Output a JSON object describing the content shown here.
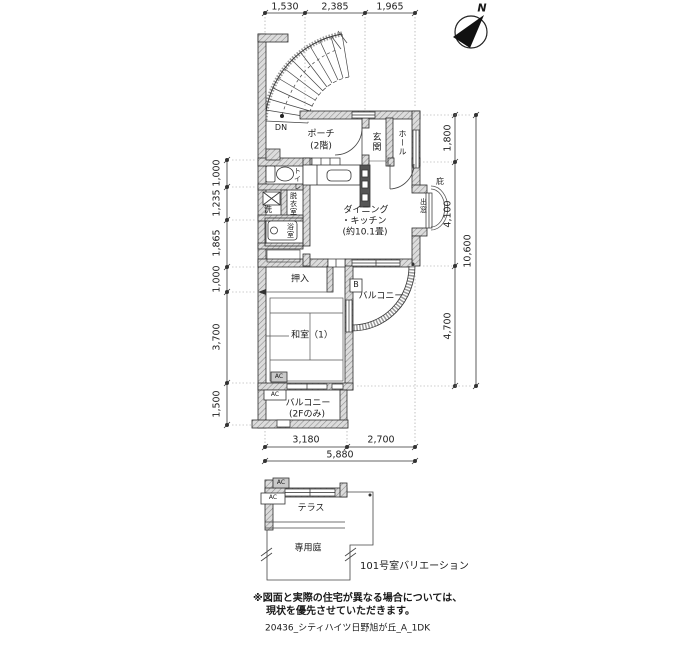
{
  "meta": {
    "title": "20436_シティハイツ日野旭が丘_A_1DK",
    "note1": "※図面と実際の住宅が異なる場合については、",
    "note2": "現状を優先させていただきます。",
    "variation": "101号室バリエーション"
  },
  "compass": {
    "north": "N"
  },
  "stairs": {
    "down": "DN"
  },
  "rooms": {
    "porch1": "ポーチ",
    "porch2": "(2階)",
    "entrance": "玄関",
    "hall": "ホール",
    "toilet": "トイレ",
    "wash": "洗",
    "dressing": "脱衣室",
    "bath": "浴室",
    "dk1": "ダイニング",
    "dk2": "・キッチン",
    "dk3": "(約10.1畳)",
    "bay_window": "出窓",
    "eaves": "庇",
    "closet": "押入",
    "washitsu": "和室（1）",
    "balcony_b": "B",
    "balcony": "バルコニー",
    "balcony2f_1": "バルコニー",
    "balcony2f_2": "(2Fのみ)",
    "terrace": "テラス",
    "garden": "専用庭",
    "ac": "AC"
  },
  "dims": {
    "top": [
      "1,530",
      "2,385",
      "1,965"
    ],
    "left": [
      "1,000",
      "1,235",
      "1,865",
      "1,000",
      "3,700",
      "1,500"
    ],
    "right": [
      "1,800",
      "4,100",
      "4,700"
    ],
    "right_total": "10,600",
    "bottom": [
      "3,180",
      "2,700"
    ],
    "bottom_total": "5,880"
  }
}
